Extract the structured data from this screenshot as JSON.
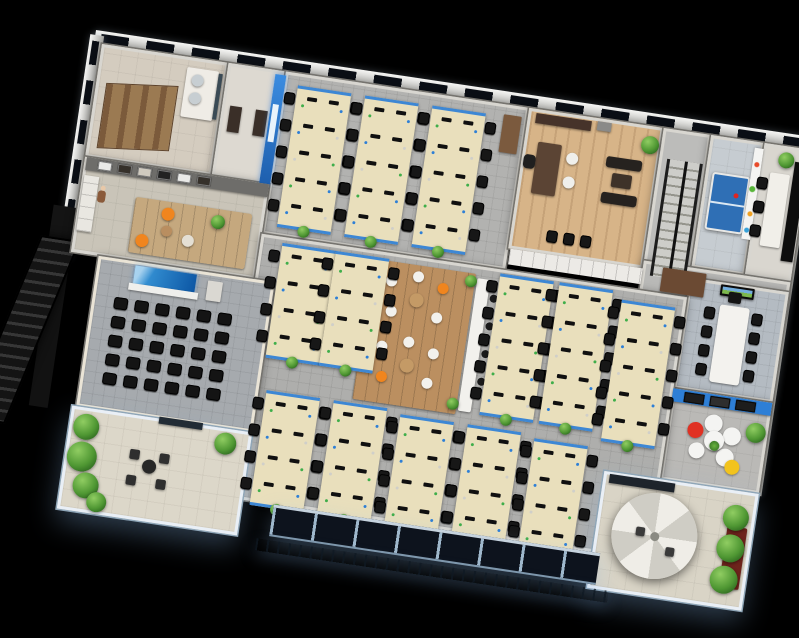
{
  "scene": {
    "description": "3D isometric render of an office floor plan on a black background, rotated 8.5 degrees",
    "background": "#000000",
    "rotation_deg": 8.5,
    "plan_width": 716,
    "plan_height": 480,
    "offset_x": 102,
    "offset_y": 44
  },
  "palette": {
    "desk": "#e9dfbc",
    "chair": "#171717",
    "accent_blue": "#2e7fd6",
    "wood_light": "#d7b488",
    "wood_mid": "#bb8f60",
    "carpet": "#aeaeac",
    "terrace_floor": "#dcd7c9",
    "facade_glass": "#0d131d",
    "glow_blue": "#bcd9f2",
    "plant_green": "#4f9733",
    "orange": "#f0851e",
    "red": "#e03123",
    "yellow": "#f2c31d",
    "white_furniture": "#f2f1ed",
    "monitor_dots": [
      "#3fae4a",
      "#2e7fd6",
      "#d0cfc9"
    ]
  },
  "elements": [
    {
      "t": "band-h",
      "n": "north-outer-wall",
      "x": -8,
      "y": -13,
      "w": 722,
      "h": 17
    },
    {
      "t": "band-v",
      "n": "west-outer-wall",
      "x": -13,
      "y": -8,
      "w": 14,
      "h": 226
    },
    {
      "t": "band-v",
      "n": "east-outer-wall",
      "x": 706,
      "y": 0,
      "w": 13,
      "h": 350
    },
    {
      "t": "box",
      "n": "west-dark-wall",
      "x": -19,
      "y": 216,
      "w": 19,
      "h": 152,
      "c": "#121212"
    },
    {
      "t": "box",
      "n": "fire-escape-landing",
      "x": -24,
      "y": 166,
      "w": 26,
      "h": 34,
      "c": "#141414"
    },
    {
      "t": "fire-stairs",
      "n": "fire-escape-stairs",
      "x": -56,
      "y": 198,
      "w": 40,
      "h": 192
    },
    {
      "t": "room",
      "n": "room-washroom",
      "x": 0,
      "y": 0,
      "w": 128,
      "h": 114,
      "floor": "#d4ccbf",
      "tex": "tile"
    },
    {
      "t": "room",
      "n": "room-storage",
      "x": 128,
      "y": 0,
      "w": 58,
      "h": 114,
      "floor": "#ddd9d1"
    },
    {
      "t": "room",
      "n": "room-open-office-north",
      "x": 186,
      "y": 0,
      "w": 246,
      "h": 164,
      "floor": "#b2b2b0",
      "tex": "carpet"
    },
    {
      "t": "room",
      "n": "room-executive-office",
      "x": 432,
      "y": 0,
      "w": 136,
      "h": 142,
      "floor": "#d7b488",
      "tex": "wood"
    },
    {
      "t": "room",
      "n": "room-stairwell",
      "x": 568,
      "y": 0,
      "w": 48,
      "h": 168,
      "floor": "#bcbcba"
    },
    {
      "t": "room",
      "n": "room-game",
      "x": 616,
      "y": 0,
      "w": 54,
      "h": 134,
      "floor": "#c6ccd1",
      "tex": "tile"
    },
    {
      "t": "room",
      "n": "room-small-meeting",
      "x": 670,
      "y": 0,
      "w": 46,
      "h": 134,
      "floor": "#d9d6cf"
    },
    {
      "t": "room",
      "n": "room-hall-east",
      "x": 568,
      "y": 134,
      "w": 148,
      "h": 36,
      "floor": "#b9b9b7"
    },
    {
      "t": "room",
      "n": "room-conference",
      "x": 616,
      "y": 144,
      "w": 100,
      "h": 112,
      "floor": "#b4bbc2",
      "tex": "carpet"
    },
    {
      "t": "room",
      "n": "room-lounge",
      "x": 616,
      "y": 256,
      "w": 100,
      "h": 92,
      "floor": "#bab9b6",
      "tex": "tile"
    },
    {
      "t": "room",
      "n": "room-reception",
      "x": 0,
      "y": 114,
      "w": 186,
      "h": 96,
      "floor": "#c9c4b8",
      "tex": "tile"
    },
    {
      "t": "room",
      "n": "room-open-office-main",
      "x": 186,
      "y": 164,
      "w": 430,
      "h": 266,
      "floor": "#aeaeac",
      "tex": "carpet"
    },
    {
      "t": "room",
      "n": "room-training",
      "x": 28,
      "y": 210,
      "w": 178,
      "h": 152,
      "floor": "#a6aaae",
      "wall": "#eae4d6",
      "tex": "carpet"
    },
    {
      "t": "room",
      "n": "terrace-garden",
      "x": 24,
      "y": 362,
      "w": 182,
      "h": 104,
      "floor": "#dcd7c9",
      "glow": true,
      "tex": "tile"
    },
    {
      "t": "room",
      "n": "terrace-umbrella",
      "x": 560,
      "y": 348,
      "w": 156,
      "h": 118,
      "floor": "#d9d4c6",
      "glow": true,
      "tex": "tile"
    },
    {
      "t": "stalls",
      "n": "toilet-stalls",
      "x": 10,
      "y": 34,
      "w": 72,
      "h": 66
    },
    {
      "t": "box",
      "n": "sink-counter",
      "x": 88,
      "y": 10,
      "w": 32,
      "h": 50,
      "c": "#efece6",
      "r": 2
    },
    {
      "t": "circle",
      "n": "sink",
      "x": 94,
      "y": 16,
      "w": 12,
      "h": 12,
      "c": "#c7ced2"
    },
    {
      "t": "circle",
      "n": "sink",
      "x": 94,
      "y": 34,
      "w": 12,
      "h": 12,
      "c": "#c7ced2"
    },
    {
      "t": "box",
      "n": "mirror",
      "x": 120,
      "y": 12,
      "w": 4,
      "h": 46,
      "c": "#3a4a55"
    },
    {
      "t": "box",
      "n": "door",
      "x": 136,
      "y": 42,
      "w": 12,
      "h": 26,
      "c": "#3a2f28"
    },
    {
      "t": "box",
      "n": "door",
      "x": 162,
      "y": 42,
      "w": 12,
      "h": 26,
      "c": "#3a2f28"
    },
    {
      "t": "accent-wall",
      "n": "blue-feature-wall",
      "x": 176,
      "y": 4,
      "w": 11,
      "h": 110
    },
    {
      "t": "desk-island",
      "n": "desk-island",
      "x": 200,
      "y": 12,
      "rows": 5
    },
    {
      "t": "desk-island",
      "n": "desk-island",
      "x": 268,
      "y": 12,
      "rows": 5
    },
    {
      "t": "desk-island",
      "n": "desk-island",
      "x": 336,
      "y": 12,
      "rows": 5
    },
    {
      "t": "box",
      "n": "tall-cabinet",
      "x": 408,
      "y": 10,
      "w": 18,
      "h": 38,
      "c": "#7b5a3e",
      "r": 1
    },
    {
      "t": "box",
      "n": "credenza",
      "x": 440,
      "y": 4,
      "w": 56,
      "h": 10,
      "c": "#46332a"
    },
    {
      "t": "box",
      "n": "wall-frame",
      "x": 502,
      "y": 3,
      "w": 14,
      "h": 9,
      "c": "#8a8a88"
    },
    {
      "t": "box",
      "n": "exec-desk",
      "x": 446,
      "y": 32,
      "w": 24,
      "h": 52,
      "c": "#5b4434",
      "r": 2
    },
    {
      "t": "box",
      "n": "exec-chair",
      "x": 434,
      "y": 46,
      "w": 12,
      "h": 14,
      "c": "#1f1f1f",
      "r": 4
    },
    {
      "t": "circle",
      "n": "guest-chair",
      "x": 476,
      "y": 38,
      "w": 12,
      "h": 12,
      "c": "#efefeb"
    },
    {
      "t": "circle",
      "n": "guest-chair",
      "x": 476,
      "y": 62,
      "w": 12,
      "h": 12,
      "c": "#efefeb"
    },
    {
      "t": "box",
      "n": "sofa",
      "x": 516,
      "y": 36,
      "w": 36,
      "h": 11,
      "c": "#26221f",
      "r": 3
    },
    {
      "t": "box",
      "n": "sofa",
      "x": 516,
      "y": 72,
      "w": 36,
      "h": 11,
      "c": "#26221f",
      "r": 3
    },
    {
      "t": "box",
      "n": "coffee-table",
      "x": 524,
      "y": 52,
      "w": 20,
      "h": 14,
      "c": "#3e3229",
      "r": 2
    },
    {
      "t": "plant",
      "n": "plant",
      "x": 548,
      "y": 10,
      "w": 18,
      "h": 18
    },
    {
      "t": "chairs",
      "n": "waiting-chairs",
      "x": 468,
      "y": 118,
      "count": 3,
      "step": 17,
      "dir": "h"
    },
    {
      "t": "box",
      "n": "cabinet-row",
      "x": 434,
      "y": 142,
      "w": 134,
      "h": 16,
      "c": "#eceae6",
      "lines": "v"
    },
    {
      "t": "stairs",
      "n": "main-staircase",
      "x": 576,
      "y": 30,
      "w": 36,
      "h": 118
    },
    {
      "t": "pingpong",
      "n": "pingpong-table",
      "x": 623,
      "y": 36,
      "w": 38,
      "h": 58
    },
    {
      "t": "poster",
      "n": "wall-poster",
      "x": 661,
      "y": 6,
      "w": 9,
      "h": 92
    },
    {
      "t": "box",
      "n": "meeting-table",
      "x": 680,
      "y": 28,
      "w": 20,
      "h": 74,
      "c": "#f1efe9",
      "r": 2
    },
    {
      "t": "chairs",
      "n": "meeting-chairs",
      "x": 668,
      "y": 34,
      "count": 3,
      "step": 24,
      "dir": "v"
    },
    {
      "t": "box",
      "n": "server-rack",
      "x": 703,
      "y": 14,
      "w": 12,
      "h": 100,
      "c": "#0d0d0d"
    },
    {
      "t": "plant",
      "n": "plant",
      "x": 686,
      "y": 6,
      "w": 16,
      "h": 16
    },
    {
      "t": "box",
      "n": "wardrobe",
      "x": 588,
      "y": 138,
      "w": 44,
      "h": 24,
      "c": "#6b4a33",
      "r": 1
    },
    {
      "t": "tv",
      "n": "conference-tv",
      "x": 648,
      "y": 146,
      "w": 34,
      "h": 11
    },
    {
      "t": "box",
      "n": "conference-table",
      "x": 650,
      "y": 166,
      "w": 30,
      "h": 78,
      "c": "#f3f2ee",
      "r": 3
    },
    {
      "t": "chairs",
      "n": "conference-chairs",
      "x": 635,
      "y": 170,
      "count": 4,
      "step": 19,
      "dir": "v"
    },
    {
      "t": "chairs",
      "n": "conference-chairs",
      "x": 683,
      "y": 170,
      "count": 4,
      "step": 19,
      "dir": "v"
    },
    {
      "t": "box",
      "n": "head-chair",
      "x": 657,
      "y": 152,
      "w": 13,
      "h": 11,
      "c": "#141414",
      "r": 2
    },
    {
      "t": "box",
      "n": "lounge-blue-wall",
      "x": 616,
      "y": 256,
      "w": 100,
      "h": 13,
      "c": "#2e7fd6"
    },
    {
      "t": "frames",
      "n": "lounge-photo-frames",
      "x": 628,
      "y": 258,
      "count": 3
    },
    {
      "t": "petal-sofa",
      "n": "petal-sofa",
      "x": 638,
      "y": 280,
      "w": 58,
      "h": 54
    },
    {
      "t": "plant",
      "n": "plant",
      "x": 694,
      "y": 278,
      "w": 20,
      "h": 20
    },
    {
      "t": "box",
      "n": "break-platform",
      "x": 300,
      "y": 172,
      "w": 104,
      "h": 142,
      "c": "#bb8f60",
      "lines": "v",
      "r": 2
    },
    {
      "t": "seat-cluster",
      "n": "cafe-seating",
      "x": 310,
      "y": 182
    },
    {
      "t": "seat-cluster",
      "n": "cafe-seating",
      "x": 310,
      "y": 248,
      "flip": true
    },
    {
      "t": "box",
      "n": "bar-counter",
      "x": 406,
      "y": 176,
      "w": 13,
      "h": 134,
      "c": "#f2f1ed",
      "r": 2
    },
    {
      "t": "chairs",
      "n": "bar-stools",
      "x": 421,
      "y": 190,
      "count": 4,
      "step": 28,
      "dir": "v",
      "small": true
    },
    {
      "t": "plant",
      "n": "plant",
      "x": 394,
      "y": 174,
      "w": 12,
      "h": 12
    },
    {
      "t": "plant",
      "n": "plant",
      "x": 394,
      "y": 298,
      "w": 12,
      "h": 12
    },
    {
      "t": "desk-island",
      "n": "desk-island",
      "x": 208,
      "y": 170,
      "rows": 4
    },
    {
      "t": "desk-island",
      "n": "desk-island",
      "x": 262,
      "y": 170,
      "rows": 4
    },
    {
      "t": "desk-island",
      "n": "desk-island",
      "x": 428,
      "y": 168,
      "rows": 5
    },
    {
      "t": "desk-island",
      "n": "desk-island",
      "x": 488,
      "y": 168,
      "rows": 5
    },
    {
      "t": "desk-island",
      "n": "desk-island",
      "x": 552,
      "y": 176,
      "rows": 5
    },
    {
      "t": "desk-island",
      "n": "desk-island",
      "x": 214,
      "y": 318,
      "rows": 4
    },
    {
      "t": "desk-island",
      "n": "desk-island",
      "x": 282,
      "y": 318,
      "rows": 4
    },
    {
      "t": "desk-island",
      "n": "desk-island",
      "x": 350,
      "y": 322,
      "rows": 4
    },
    {
      "t": "desk-island",
      "n": "desk-island",
      "x": 418,
      "y": 322,
      "rows": 4
    },
    {
      "t": "desk-island",
      "n": "desk-island",
      "x": 486,
      "y": 326,
      "rows": 4
    },
    {
      "t": "screen",
      "n": "projection-screen",
      "x": 66,
      "y": 214,
      "w": 62,
      "h": 18
    },
    {
      "t": "box",
      "n": "podium",
      "x": 140,
      "y": 218,
      "w": 15,
      "h": 20,
      "c": "#dad8d2",
      "r": 1
    },
    {
      "t": "chairs-grid",
      "n": "training-chairs",
      "x": 50,
      "y": 248,
      "cols": 6,
      "rows": 5,
      "gx": 21,
      "gy": 19
    },
    {
      "t": "box",
      "n": "photo-wall",
      "x": 2,
      "y": 114,
      "w": 184,
      "h": 13,
      "c": "#6e6d6a"
    },
    {
      "t": "frames",
      "n": "reception-photo-frames",
      "x": 14,
      "y": 116,
      "count": 6,
      "light": true
    },
    {
      "t": "box",
      "n": "kitchen-counter",
      "x": 2,
      "y": 132,
      "w": 15,
      "h": 56,
      "c": "#e9e7e1",
      "lines": "h"
    },
    {
      "t": "person",
      "n": "person",
      "x": 17,
      "y": 140
    },
    {
      "t": "box",
      "n": "reception-rug",
      "x": 56,
      "y": 146,
      "w": 118,
      "h": 56,
      "c": "#c5a87e",
      "r": 3,
      "lines": "v"
    },
    {
      "t": "circle",
      "n": "armchair-orange",
      "x": 84,
      "y": 152,
      "w": 13,
      "h": 13,
      "c": "#f0851e"
    },
    {
      "t": "circle",
      "n": "armchair-orange",
      "x": 62,
      "y": 182,
      "w": 13,
      "h": 13,
      "c": "#f0851e"
    },
    {
      "t": "circle",
      "n": "armchair-white",
      "x": 108,
      "y": 176,
      "w": 12,
      "h": 12,
      "c": "#e4dfd4"
    },
    {
      "t": "circle",
      "n": "round-table",
      "x": 86,
      "y": 170,
      "w": 11,
      "h": 11,
      "c": "#b98e60"
    },
    {
      "t": "plant",
      "n": "plant",
      "x": 134,
      "y": 152,
      "w": 14,
      "h": 14
    },
    {
      "t": "box",
      "n": "glass-door",
      "x": 112,
      "y": 360,
      "w": 44,
      "h": 7,
      "c": "#222c35"
    },
    {
      "t": "plant",
      "n": "garden-plant",
      "x": 28,
      "y": 368,
      "w": 26,
      "h": 26
    },
    {
      "t": "plant",
      "n": "garden-plant",
      "x": 26,
      "y": 396,
      "w": 30,
      "h": 30
    },
    {
      "t": "plant",
      "n": "garden-plant",
      "x": 36,
      "y": 426,
      "w": 26,
      "h": 26
    },
    {
      "t": "plant",
      "n": "garden-plant",
      "x": 52,
      "y": 444,
      "w": 20,
      "h": 20
    },
    {
      "t": "plant",
      "n": "garden-plant",
      "x": 170,
      "y": 366,
      "w": 22,
      "h": 22
    },
    {
      "t": "circle",
      "n": "patio-table",
      "x": 102,
      "y": 404,
      "w": 14,
      "h": 14,
      "c": "#272727"
    },
    {
      "t": "box",
      "n": "patio-chair",
      "x": 88,
      "y": 396,
      "w": 10,
      "h": 10,
      "c": "#2f2f2f",
      "r": 2
    },
    {
      "t": "box",
      "n": "patio-chair",
      "x": 118,
      "y": 396,
      "w": 10,
      "h": 10,
      "c": "#2f2f2f",
      "r": 2
    },
    {
      "t": "box",
      "n": "patio-chair",
      "x": 88,
      "y": 422,
      "w": 10,
      "h": 10,
      "c": "#2f2f2f",
      "r": 2
    },
    {
      "t": "box",
      "n": "patio-chair",
      "x": 118,
      "y": 422,
      "w": 10,
      "h": 10,
      "c": "#2f2f2f",
      "r": 2
    },
    {
      "t": "box",
      "n": "privacy-screen",
      "x": 566,
      "y": 350,
      "w": 66,
      "h": 9,
      "c": "#1e242c"
    },
    {
      "t": "box",
      "n": "planter",
      "x": 690,
      "y": 384,
      "w": 20,
      "h": 62,
      "c": "#6e241c",
      "r": 2
    },
    {
      "t": "umbrella",
      "n": "patio-umbrella",
      "x": 576,
      "y": 362,
      "w": 86,
      "h": 86
    },
    {
      "t": "box",
      "n": "patio-chair",
      "x": 600,
      "y": 398,
      "w": 9,
      "h": 9,
      "c": "#3a3a3a",
      "r": 2
    },
    {
      "t": "box",
      "n": "patio-chair",
      "x": 632,
      "y": 414,
      "w": 9,
      "h": 9,
      "c": "#3a3a3a",
      "r": 2
    },
    {
      "t": "plant",
      "n": "terrace-plant",
      "x": 684,
      "y": 362,
      "w": 26,
      "h": 26
    },
    {
      "t": "plant",
      "n": "terrace-plant",
      "x": 682,
      "y": 392,
      "w": 28,
      "h": 28
    },
    {
      "t": "plant",
      "n": "terrace-plant",
      "x": 680,
      "y": 424,
      "w": 28,
      "h": 28
    },
    {
      "t": "facade",
      "n": "balcony-glass-facade",
      "x": 238,
      "y": 430,
      "w": 330,
      "h": 32
    },
    {
      "t": "railing",
      "n": "balcony-railing",
      "x": 226,
      "y": 466,
      "w": 356,
      "h": 12
    }
  ]
}
